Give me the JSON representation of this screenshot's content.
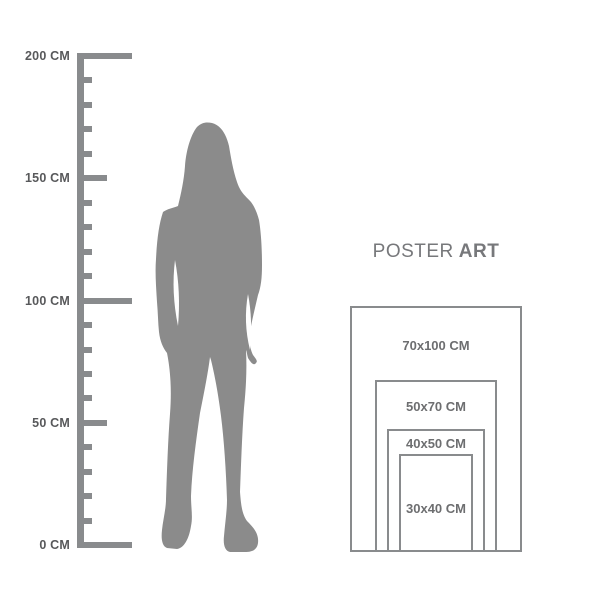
{
  "title": {
    "word_light": "POSTER",
    "word_bold": "ART"
  },
  "ruler": {
    "unit": "CM",
    "min_cm": 0,
    "max_cm": 200,
    "minor_step_cm": 10,
    "labels": [
      {
        "cm": 200,
        "text": "200 CM"
      },
      {
        "cm": 150,
        "text": "150 CM"
      },
      {
        "cm": 100,
        "text": "100 CM"
      },
      {
        "cm": 50,
        "text": "50 CM"
      },
      {
        "cm": 0,
        "text": "0 CM"
      }
    ]
  },
  "figure": {
    "name": "standing-woman-silhouette"
  },
  "poster_sizes": [
    {
      "label": "70x100 CM",
      "width_cm": 70,
      "height_cm": 100
    },
    {
      "label": "50x70 CM",
      "width_cm": 50,
      "height_cm": 70
    },
    {
      "label": "40x50 CM",
      "width_cm": 40,
      "height_cm": 50
    },
    {
      "label": "30x40 CM",
      "width_cm": 30,
      "height_cm": 40
    }
  ],
  "colors": {
    "background": "#ffffff",
    "graphic_gray": "#898b8d",
    "silhouette_gray": "#8b8b8b",
    "ruler_label": "#58595b",
    "size_label": "#6d6e70",
    "title_gray": "#77787b"
  }
}
